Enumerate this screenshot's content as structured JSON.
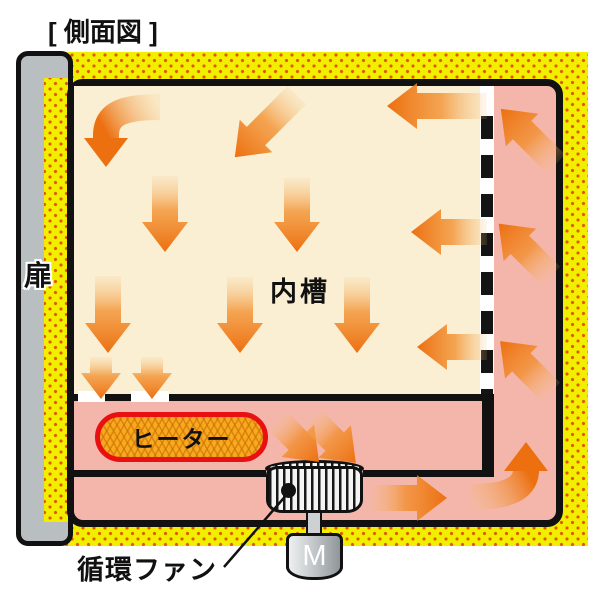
{
  "diagram": {
    "title": "[ 側面図 ]",
    "door_label": "扉",
    "inner_chamber_label": "内槽",
    "heater_label": "ヒーター",
    "fan_label": "循環ファン",
    "motor_label": "M"
  },
  "colors": {
    "insulation_yellow": "#F2EE00",
    "insulation_dot": "#E05800",
    "duct_pink": "#F4B6AA",
    "chamber_cream": "#FAEFD2",
    "arrow_orange": "#EC6F10",
    "heater_fill": "#F7A91F",
    "heater_border_red": "#E81010",
    "door_gray": "#B9BEC1",
    "outline_black": "#111111"
  },
  "airflow": {
    "arrow_color": "#EC6F10",
    "chamber_arrow_count": 12,
    "duct_arrow_count": 7
  }
}
